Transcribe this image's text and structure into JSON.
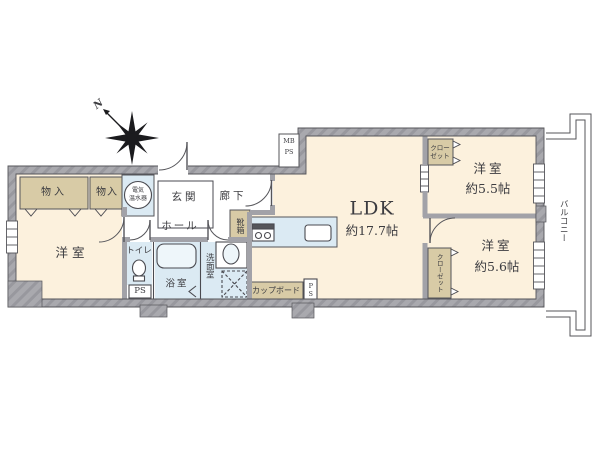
{
  "compass": {
    "north": "N"
  },
  "labels": {
    "meter_box_line1": "MB",
    "meter_box_line2": "PS",
    "storage_left": "物入",
    "storage_right": "物入",
    "water_heater_line1": "電気",
    "water_heater_line2": "温水器",
    "entrance": "玄関",
    "corridor": "廊下",
    "hall": "ホール",
    "shoe_box": "靴箱",
    "bedroom_left": "洋室",
    "toilet": "トイレ",
    "toilet_ps": "PS",
    "bathroom": "浴室",
    "washroom": "洗面室",
    "cupboard": "カップボード",
    "cupboard_ps": "PS",
    "ldk_name": "LDK",
    "ldk_size": "約17.7帖",
    "closet_top_line1": "クロー",
    "closet_top_line2": "ゼット",
    "bedroom_top_right": "洋室",
    "bedroom_top_right_size": "約5.5帖",
    "closet_bottom": "クローゼット",
    "bedroom_bottom_right": "洋室",
    "bedroom_bottom_right_size": "約5.6帖",
    "balcony": "バルコニー"
  },
  "colors": {
    "room_cream": "#fcf1dd",
    "storage_tan": "#d8cba6",
    "wet_area_blue": "#dbeaf3",
    "wall_gray": "#a9a9ae",
    "line": "#55555a"
  }
}
